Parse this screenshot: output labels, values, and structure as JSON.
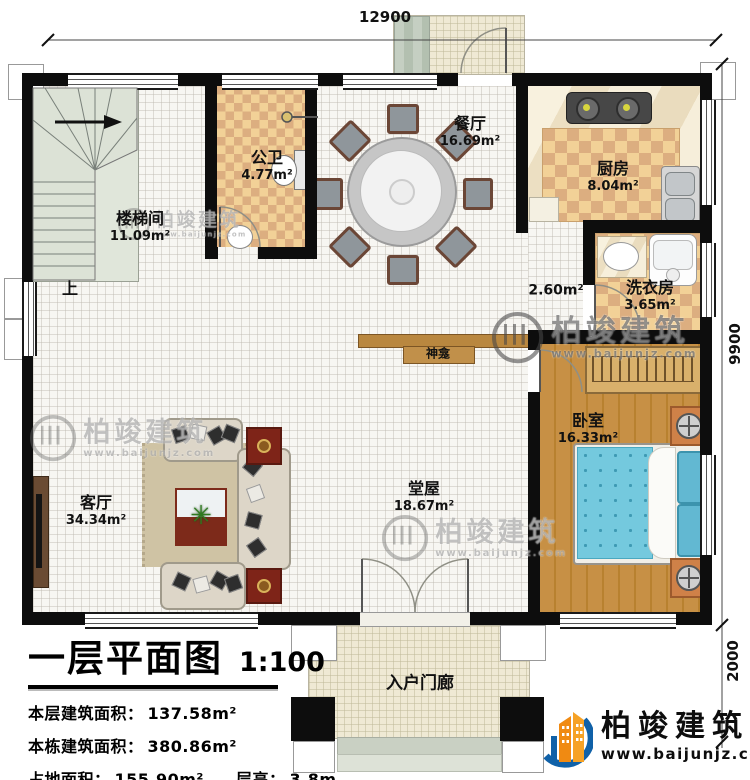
{
  "dimensions": {
    "top": "12900",
    "side": "9900",
    "porch": "2000"
  },
  "rooms": {
    "stairwell": {
      "name": "楼梯间",
      "area": "11.09m²"
    },
    "bathroom": {
      "name": "公卫",
      "area": "4.77m²"
    },
    "dining": {
      "name": "餐厅",
      "area": "16.69m²"
    },
    "kitchen": {
      "name": "厨房",
      "area": "8.04m²"
    },
    "laundry": {
      "name": "洗衣房",
      "area": "3.65m²"
    },
    "vestibule": {
      "area": "2.60m²"
    },
    "shrine": {
      "name": "神龛"
    },
    "bedroom": {
      "name": "卧室",
      "area": "16.33m²"
    },
    "hall": {
      "name": "堂屋",
      "area": "18.67m²"
    },
    "living": {
      "name": "客厅",
      "area": "34.34m²"
    },
    "porch": {
      "name": "入户门廊"
    }
  },
  "stairs": {
    "up_label": "上"
  },
  "icons": {
    "plant": "✳"
  },
  "title_block": {
    "title": "一层平面图",
    "scale": "1:100",
    "lines": [
      {
        "label": "本层建筑面积：",
        "value": "137.58m²"
      },
      {
        "label": "本栋建筑面积：",
        "value": "380.86m²"
      },
      {
        "label": "占地面积：",
        "value": "155.90m²",
        "label2": "层高：",
        "value2": "3.8m"
      }
    ]
  },
  "brand": {
    "name": "柏竣建筑",
    "url": "www.baijunjz.com"
  },
  "watermark": {
    "name": "柏竣建筑",
    "url": "www.baijunjz.com"
  },
  "colors": {
    "wall": "#0d0d0d",
    "checker_light": "#f2d197",
    "checker_dark": "#dcae80",
    "wood": "#c18a3e",
    "bed": "#74c9de",
    "brand_orange": "#f08a12",
    "brand_blue": "#1061a8"
  }
}
